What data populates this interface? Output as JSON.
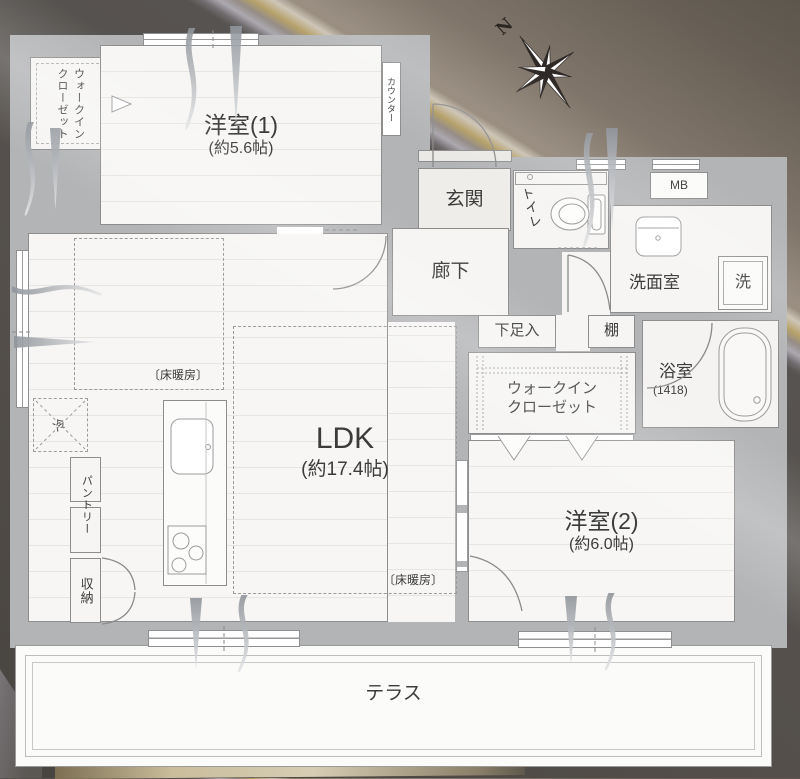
{
  "background": {
    "dark": "#55504b",
    "band_light": "#a9a5ad",
    "band_gold": "#b0995d",
    "band_beige": "#c9c0b0",
    "brown": "#877b6d"
  },
  "plan": {
    "wall_color": "#b3b4b6",
    "floor_color": "#f6f5f3",
    "line_color": "#8d8d8d"
  },
  "compass": {
    "north": "N"
  },
  "rooms": {
    "wic1": {
      "line1": "ウォークイン",
      "line2": "クローゼット"
    },
    "bedroom1": {
      "name": "洋室(1)",
      "size": "(約5.6帖)"
    },
    "counter": {
      "label": "カウンター"
    },
    "genkan": {
      "label": "玄関"
    },
    "toilet": {
      "label": "トイレ"
    },
    "mb": {
      "label": "MB"
    },
    "hallway": {
      "label": "廊下"
    },
    "washroom": {
      "label": "洗面室"
    },
    "washer": {
      "label": "洗"
    },
    "shoe": {
      "label": "下足入"
    },
    "shelf": {
      "label": "棚"
    },
    "bath": {
      "name": "浴室",
      "size": "(1418)"
    },
    "wic2": {
      "line1": "ウォークイン",
      "line2": "クローゼット"
    },
    "ldk": {
      "name": "LDK",
      "size": "(約17.4帖)"
    },
    "floor_heating_1": {
      "label": "〔床暖房〕"
    },
    "floor_heating_2": {
      "label": "〔床暖房〕"
    },
    "fridge": {
      "label": "冷"
    },
    "pantry": {
      "label": "パントリー"
    },
    "storage": {
      "label": "収納"
    },
    "bedroom2": {
      "name": "洋室(2)",
      "size": "(約6.0帖)"
    },
    "terrace": {
      "label": "テラス"
    }
  }
}
